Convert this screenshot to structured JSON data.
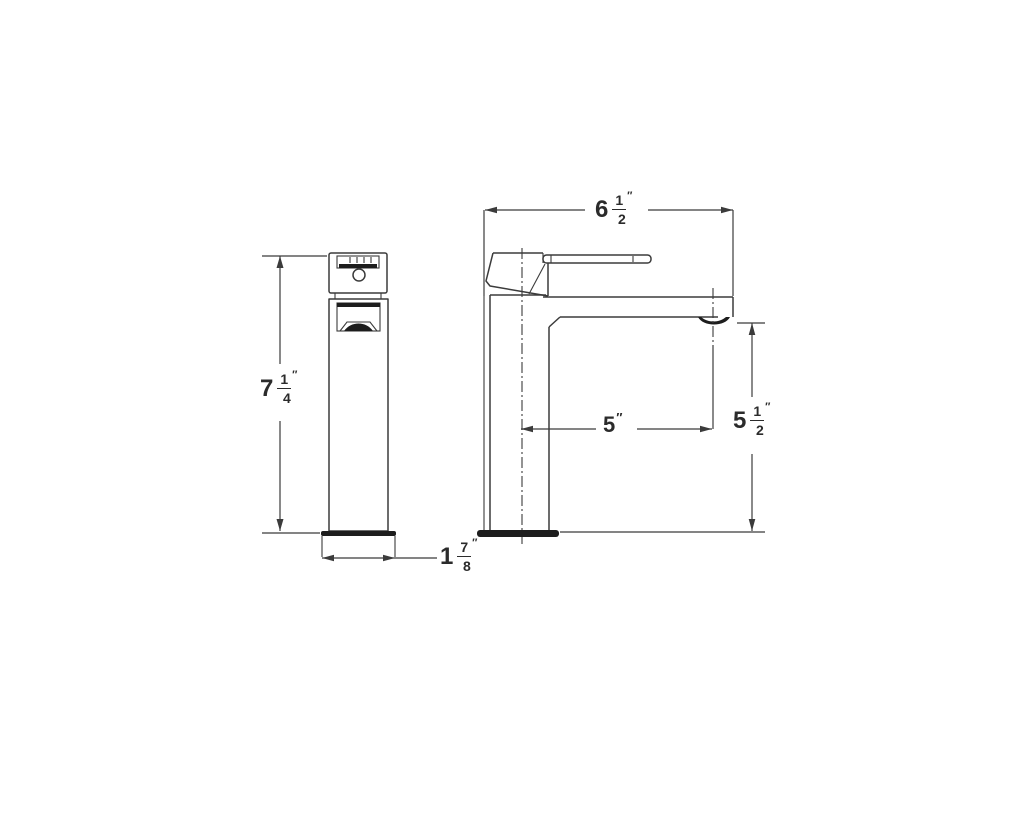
{
  "drawing": {
    "type": "technical-spec-drawing",
    "subject": "single-handle bathroom faucet, front and side orthographic views"
  },
  "colors": {
    "background": "#ffffff",
    "line": "#3b3b3b",
    "dark_fill": "#1d1d1d",
    "text": "#2b2b2b"
  },
  "dimensions": {
    "height": {
      "whole": "7",
      "numerator": "1",
      "denominator": "4",
      "unit": "″",
      "reading": "7 1/4 in overall height (front view)"
    },
    "base_width": {
      "whole": "1",
      "numerator": "7",
      "denominator": "8",
      "unit": "″",
      "reading": "1 7/8 in base width (front view)"
    },
    "overall_depth": {
      "whole": "6",
      "numerator": "1",
      "denominator": "2",
      "unit": "″",
      "reading": "6 1/2 in overall depth (side view)"
    },
    "spout_reach": {
      "whole": "5",
      "unit": "″",
      "reading": "5 in spout reach from centerline (side view)"
    },
    "spout_height": {
      "whole": "5",
      "numerator": "1",
      "denominator": "2",
      "unit": "″",
      "reading": "5 1/2 in spout outlet height (side view)"
    }
  }
}
